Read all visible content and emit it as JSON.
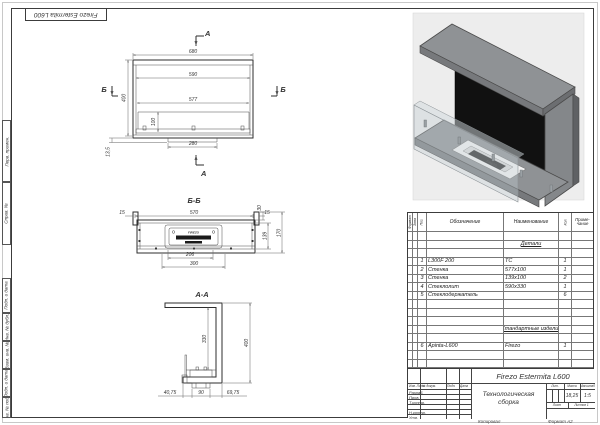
{
  "page": {
    "stamp_top": "Firezo Estermita L600"
  },
  "margin_labels": {
    "perv": "Перв. примен.",
    "sprav": "Справ. №",
    "podp1": "Подп. и дата",
    "inv_dubl": "Инв. № дубл.",
    "vzam": "Взам. инв. №",
    "podp2": "Подп. и дата",
    "inv_podl": "Инв. № подл."
  },
  "views": {
    "front": {
      "section_a": "А",
      "section_b": "Б",
      "dim_680": "680",
      "dim_590": "590",
      "dim_577": "577",
      "dim_400": "400",
      "dim_100": "100",
      "dim_280": "280",
      "dim_135": "13,5"
    },
    "bb": {
      "title": "Б-Б",
      "dim_570": "570",
      "dim_15l": "15",
      "dim_15r": "15",
      "dim_30": "30",
      "dim_139": "139",
      "dim_170": "170",
      "dim_206": "206",
      "dim_300": "300",
      "brand": "FIREZO"
    },
    "aa": {
      "title": "А-А",
      "dim_400": "400",
      "dim_330": "330",
      "dim_4075": "40,75",
      "dim_90": "90",
      "dim_6975": "69,75"
    },
    "iso": {
      "brand": "FIREZO"
    }
  },
  "spec": {
    "headers": {
      "format": "Формат",
      "zona": "Зона",
      "poz": "Поз.",
      "oboz": "Обозначение",
      "naim": "Наименование",
      "qty": "Кол.",
      "note_l1": "Приме-",
      "note_l2": "чание"
    },
    "rows": [
      {
        "pos": "",
        "oboz": "",
        "name": "",
        "qty": ""
      },
      {
        "pos": "",
        "oboz": "",
        "name": "Детали",
        "qty": ""
      },
      {
        "pos": "",
        "oboz": "",
        "name": "",
        "qty": ""
      },
      {
        "pos": "1",
        "oboz": "L300F 200",
        "name": "ТС",
        "qty": "1"
      },
      {
        "pos": "2",
        "oboz": "Стенка",
        "name": "577x100",
        "qty": "1"
      },
      {
        "pos": "3",
        "oboz": "Стенка",
        "name": "139x100",
        "qty": "2"
      },
      {
        "pos": "4",
        "oboz": "Стеклолит",
        "name": "590x330",
        "qty": "1"
      },
      {
        "pos": "5",
        "oboz": "Стеклодержатель",
        "name": "",
        "qty": "6"
      },
      {
        "pos": "",
        "oboz": "",
        "name": "",
        "qty": ""
      },
      {
        "pos": "",
        "oboz": "",
        "name": "",
        "qty": ""
      },
      {
        "pos": "",
        "oboz": "",
        "name": "",
        "qty": ""
      },
      {
        "pos": "",
        "oboz": "",
        "name": "Стандартные изделия",
        "qty": ""
      },
      {
        "pos": "",
        "oboz": "",
        "name": "",
        "qty": ""
      },
      {
        "pos": "6",
        "oboz": "Apinta-L600",
        "name": "Firezo",
        "qty": "1"
      },
      {
        "pos": "",
        "oboz": "",
        "name": "",
        "qty": ""
      },
      {
        "pos": "",
        "oboz": "",
        "name": "",
        "qty": ""
      }
    ]
  },
  "titleblock": {
    "designation": "Firezo Estermita L600",
    "doc_name_l1": "Технологическая",
    "doc_name_l2": "сборка",
    "col_izm": "Изм. Лист",
    "col_doc": "№ докум.",
    "col_podp": "Подп.",
    "col_data": "Дата",
    "role_1": "Разраб.",
    "role_2": "Пров.",
    "role_3": "Т.контр.",
    "role_4": "Н.контр.",
    "role_5": "Утв.",
    "lit_label": "Лит.",
    "mass_label": "Масса",
    "scale_label": "Масштаб",
    "mass_val": "18,25",
    "scale_val": "1:5",
    "sheet_label": "Лист",
    "sheets_label": "Листов 1"
  },
  "footer": {
    "copied": "Копировал",
    "format": "Формат  А2"
  }
}
